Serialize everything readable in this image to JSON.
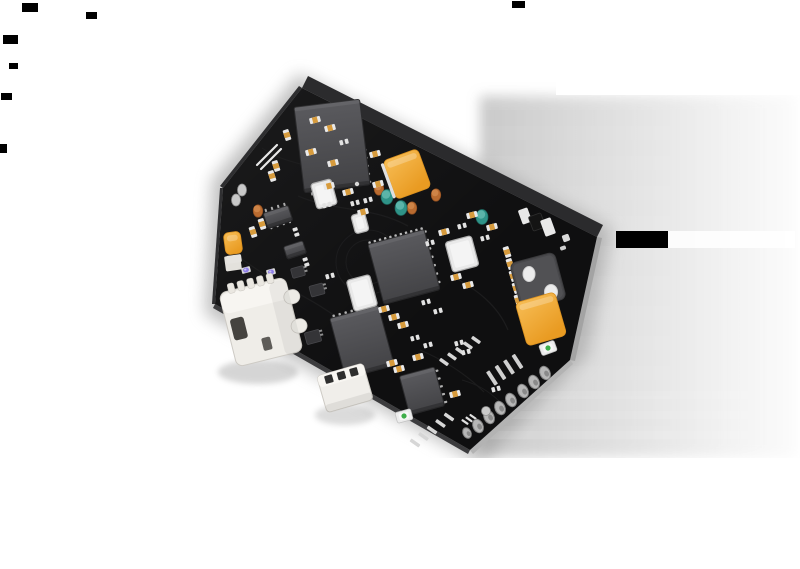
{
  "meta": {
    "description": "3D render of a black hexagonal PCB dev board tilted in perspective, with micro-USB and JST connectors, two amber components, chips, capacitors, castellated pads, a soft gray drop shadow and small black render artifacts on a white background",
    "background": "#ffffff",
    "width": 800,
    "height": 569
  },
  "palette": {
    "board": "#0F0F10",
    "chip_dark": "#454548",
    "chip_mid": "#56565A",
    "amber": "#F0A733",
    "teal": "#2F9388",
    "rust": "#B96B30",
    "ivory": "#EFEDE8",
    "pad_white": "#E9E9E9",
    "purple": "#8F7FE8",
    "led_green": "#3FAE4A",
    "shadow_gray": "#9B9B9B"
  },
  "artifacts": [
    [
      22,
      3,
      16,
      9
    ],
    [
      86,
      12,
      11,
      7
    ],
    [
      3,
      35,
      15,
      9
    ],
    [
      9,
      63,
      9,
      6
    ],
    [
      1,
      93,
      11,
      7
    ],
    [
      512,
      1,
      13,
      7
    ],
    [
      0,
      144,
      7,
      9
    ],
    [
      616,
      231,
      52,
      17
    ]
  ],
  "shadow": {
    "halo": {
      "pts": [
        [
          298,
          74
        ],
        [
          612,
          228
        ],
        [
          588,
          354
        ],
        [
          480,
          464
        ],
        [
          205,
          314
        ],
        [
          212,
          180
        ]
      ],
      "fill": "#8E8E8E",
      "opacity": 0.55
    },
    "sheet": {
      "x": 480,
      "y": 96,
      "w": 315,
      "h": 361
    },
    "bands": {
      "count": 12,
      "x": 480,
      "y0": 96,
      "step": 30,
      "h": 14,
      "w": 315,
      "opacity": 0.045
    },
    "bands2": [
      [
        480,
        391,
        315,
        8
      ],
      [
        480,
        411,
        315,
        8
      ],
      [
        480,
        431,
        315,
        8
      ]
    ],
    "gap": [
      668,
      231,
      127,
      17
    ],
    "cut_bottom": [
      428,
      458,
      372,
      111
    ],
    "cut_top": [
      556,
      58,
      244,
      37
    ]
  },
  "board": {
    "outline": [
      [
        302,
        88
      ],
      [
        597,
        237
      ],
      [
        570,
        360
      ],
      [
        470,
        450
      ],
      [
        215,
        304
      ],
      [
        223,
        188
      ]
    ],
    "fill": "#0F0F10",
    "walls": [
      {
        "name": "wall-top-right",
        "pts": [
          [
            302,
            88
          ],
          [
            597,
            237
          ],
          [
            603,
            225
          ],
          [
            308,
            76
          ]
        ],
        "fill": "#2B2B2D"
      },
      {
        "name": "wall-right",
        "pts": [
          [
            597,
            237
          ],
          [
            570,
            360
          ],
          [
            575,
            361
          ],
          [
            602,
            238
          ]
        ],
        "fill": "#A3A3A3"
      },
      {
        "name": "wall-bottom-right",
        "pts": [
          [
            570,
            360
          ],
          [
            470,
            450
          ],
          [
            473,
            454
          ],
          [
            573,
            364
          ]
        ],
        "fill": "#B3B3B3"
      },
      {
        "name": "wall-bottom-left",
        "pts": [
          [
            470,
            450
          ],
          [
            215,
            304
          ],
          [
            213,
            308
          ],
          [
            468,
            454
          ]
        ],
        "fill": "#3C3C3E"
      },
      {
        "name": "wall-left",
        "pts": [
          [
            215,
            304
          ],
          [
            223,
            188
          ],
          [
            220,
            188
          ],
          [
            212,
            304
          ]
        ],
        "fill": "#303032"
      },
      {
        "name": "wall-top-left",
        "pts": [
          [
            223,
            188
          ],
          [
            302,
            88
          ],
          [
            299,
            86
          ],
          [
            220,
            186
          ]
        ],
        "fill": "#2E2E30"
      }
    ]
  },
  "traces": [
    {
      "d": "M238,256 C275,285 315,298 348,326",
      "w": 1.3
    },
    {
      "d": "M298,196 C335,212 372,206 408,226",
      "w": 1.3
    },
    {
      "d": "M452,276 C478,290 498,306 508,330",
      "w": 1.2
    },
    {
      "d": "M262,148 C288,166 306,160 322,176",
      "w": 1.2
    },
    {
      "d": "M420,350 C448,362 468,376 484,392",
      "w": 1.2
    },
    {
      "d": "M500,402 C488,390 476,384 462,380",
      "w": 1.0
    },
    {
      "d": "M346,262 a22,22 0 1 0 44,0 a22,22 0 1 0 -44,0",
      "w": 1.0
    },
    {
      "d": "M336,262 a32,32 0 1 0 64,0 a32,32 0 1 0 -64,0",
      "w": 1.0
    }
  ],
  "pin_rows": [
    {
      "name": "qfn-pins-top",
      "x": 370,
      "y": 244,
      "c": 11,
      "dx": 5.2,
      "dy": -1.4,
      "w": 2.4,
      "h": 5.5,
      "r": -15,
      "f": "#B8B8B8"
    },
    {
      "name": "qfn-pins-right",
      "x": 424,
      "y": 232,
      "c": 7,
      "dx": 2.3,
      "dy": 8.4,
      "w": 5.5,
      "h": 2.4,
      "r": -15,
      "f": "#B8B8B8"
    },
    {
      "name": "module-pins-right",
      "x": 364,
      "y": 150,
      "c": 5,
      "dx": 1.2,
      "dy": 8,
      "w": 5,
      "h": 2.2,
      "r": -7,
      "f": "#9C9C9C"
    },
    {
      "name": "module-pins-bottom",
      "x": 312,
      "y": 193,
      "c": 3,
      "dx": 9,
      "dy": -1.1,
      "w": 2.2,
      "h": 5,
      "r": -7,
      "f": "#9C9C9C"
    },
    {
      "name": "chipb-pins-top",
      "x": 334,
      "y": 317,
      "c": 8,
      "dx": 6,
      "dy": -1.6,
      "w": 2.4,
      "h": 5,
      "r": -15,
      "f": "#B0B0B0"
    },
    {
      "name": "chipc-pins-right",
      "x": 436,
      "y": 371,
      "c": 5,
      "dx": 2.2,
      "dy": 7.8,
      "w": 5,
      "h": 2.2,
      "r": -15,
      "f": "#B0B0B0"
    },
    {
      "name": "soic-pins-top",
      "x": 266,
      "y": 211,
      "c": 4,
      "dx": 6.2,
      "dy": -2,
      "w": 2,
      "h": 4.5,
      "r": -18,
      "f": "#ABABAB"
    },
    {
      "name": "soic-pins-bottom",
      "x": 271,
      "y": 227,
      "c": 4,
      "dx": 6.2,
      "dy": -2,
      "w": 2,
      "h": 4.5,
      "r": -18,
      "f": "#ABABAB"
    },
    {
      "name": "edge-pads-row-a",
      "x": 415,
      "y": 443,
      "c": 5,
      "dx": 8.5,
      "dy": -6.5,
      "w": 3.5,
      "h": 11,
      "r": -55,
      "f": "#D6D6D6"
    },
    {
      "name": "edge-pads-row-b",
      "x": 444,
      "y": 362,
      "c": 5,
      "dx": 8,
      "dy": -5.5,
      "w": 3.5,
      "h": 10,
      "r": -55,
      "f": "#D6D6D6"
    },
    {
      "name": "ladder-footprint",
      "x": 492,
      "y": 378,
      "c": 4,
      "dx": 8.5,
      "dy": -5.5,
      "w": 4,
      "h": 16,
      "r": -33,
      "f": "#CFCFCF"
    },
    {
      "name": "e-mark-pads",
      "x": 465,
      "y": 422,
      "c": 3,
      "dx": 4,
      "dy": -2.6,
      "w": 2.2,
      "h": 8,
      "r": -55,
      "f": "#E0E0E0"
    }
  ],
  "chips": [
    {
      "name": "rf-module-chip",
      "x": 332,
      "y": 146,
      "w": 66,
      "h": 86,
      "r": -7
    },
    {
      "name": "main-mcu-qfn",
      "x": 404,
      "y": 267,
      "w": 58,
      "h": 62,
      "r": -15
    },
    {
      "name": "chip-b",
      "x": 362,
      "y": 342,
      "w": 50,
      "h": 62,
      "r": -15
    },
    {
      "name": "chip-c",
      "x": 422,
      "y": 391,
      "w": 36,
      "h": 40,
      "r": -15
    },
    {
      "name": "soic8-chip",
      "x": 278,
      "y": 217,
      "w": 26,
      "h": 16,
      "r": -18
    },
    {
      "name": "small-ic",
      "x": 295,
      "y": 250,
      "w": 20,
      "h": 13,
      "r": -18
    }
  ],
  "sots": [
    [
      298,
      272,
      13,
      10
    ],
    [
      317,
      290,
      14,
      11
    ],
    [
      313,
      337,
      15,
      12
    ]
  ],
  "crystals": [
    [
      324,
      194,
      21,
      26
    ],
    [
      360,
      223,
      14,
      19
    ],
    [
      462,
      254,
      27,
      31
    ],
    [
      362,
      293,
      24,
      32
    ]
  ],
  "buttons": [
    {
      "name": "amber-component-top",
      "x": 407,
      "y": 174,
      "w": 37,
      "h": 41,
      "r": -20,
      "rim": true
    },
    {
      "name": "amber-component-right",
      "x": 541,
      "y": 319,
      "w": 41,
      "h": 45,
      "r": -16,
      "rim": false
    },
    {
      "name": "gold-capacitor",
      "x": 233,
      "y": 243,
      "w": 17,
      "h": 22,
      "r": -8,
      "rim": false
    }
  ],
  "rects": [
    {
      "name": "white-part-near-corner",
      "x": 525,
      "y": 216,
      "w": 10,
      "h": 15,
      "r": -20,
      "f": "#E8E8E8"
    },
    {
      "name": "black-part-near-corner",
      "x": 537,
      "y": 222,
      "w": 13,
      "h": 15,
      "r": -20,
      "f": "#141414",
      "s": "#2F2F2F"
    },
    {
      "name": "white-part-near-corner-2",
      "x": 548,
      "y": 227,
      "w": 11,
      "h": 17,
      "r": -20,
      "f": "#E8E8E8"
    },
    {
      "name": "tiny-white-pad",
      "x": 566,
      "y": 238,
      "w": 7,
      "h": 7,
      "r": -20,
      "f": "#DADADA"
    },
    {
      "name": "tiny-white-pad-2",
      "x": 563,
      "y": 248,
      "w": 6,
      "h": 4,
      "r": -20,
      "f": "#CFCFCF"
    },
    {
      "name": "white-bracket",
      "x": 233,
      "y": 263,
      "w": 16,
      "h": 15,
      "r": -8,
      "f": "#E3E1DC"
    },
    {
      "name": "gold-cap-base",
      "x": 234,
      "y": 259,
      "w": 15,
      "h": 8,
      "r": -8,
      "f": "#E6E4E0"
    }
  ],
  "cyls": {
    "rust": [
      [
        379,
        189
      ],
      [
        412,
        208
      ],
      [
        436,
        195
      ],
      [
        258,
        211
      ]
    ],
    "teal": [
      [
        387,
        197
      ],
      [
        401,
        208
      ],
      [
        482,
        217
      ]
    ]
  },
  "caps": [
    [
      287,
      135,
      72
    ],
    [
      276,
      166,
      72
    ],
    [
      272,
      176,
      72
    ],
    [
      262,
      224,
      72
    ],
    [
      253,
      232,
      72
    ],
    [
      311,
      152,
      -15
    ],
    [
      333,
      163,
      -15
    ],
    [
      348,
      192,
      -15
    ],
    [
      329,
      186,
      -15
    ],
    [
      363,
      212,
      -15
    ],
    [
      375,
      154,
      -15
    ],
    [
      378,
      184,
      -15
    ],
    [
      444,
      232,
      -15
    ],
    [
      456,
      277,
      -15
    ],
    [
      468,
      285,
      -15
    ],
    [
      384,
      309,
      -15
    ],
    [
      394,
      317,
      -15
    ],
    [
      403,
      325,
      -15
    ],
    [
      418,
      357,
      -15
    ],
    [
      392,
      363,
      -15
    ],
    [
      399,
      369,
      -15
    ],
    [
      455,
      394,
      -15
    ],
    [
      472,
      215,
      -15
    ],
    [
      492,
      227,
      -15
    ],
    [
      315,
      120,
      -15
    ],
    [
      330,
      128,
      -15
    ],
    [
      507,
      252,
      72
    ],
    [
      510,
      264,
      72
    ],
    [
      513,
      276,
      72
    ],
    [
      516,
      288,
      72
    ],
    [
      518,
      300,
      72
    ]
  ],
  "pad_pairs": [
    [
      344,
      142,
      -15
    ],
    [
      355,
      203,
      -15
    ],
    [
      368,
      200,
      -15
    ],
    [
      430,
      243,
      -15
    ],
    [
      462,
      226,
      -15
    ],
    [
      485,
      238,
      -15
    ],
    [
      327,
      205,
      -15
    ],
    [
      296,
      232,
      72
    ],
    [
      306,
      262,
      72
    ],
    [
      330,
      276,
      -15
    ],
    [
      426,
      302,
      -15
    ],
    [
      438,
      311,
      -15
    ],
    [
      415,
      338,
      -15
    ],
    [
      428,
      345,
      -15
    ],
    [
      459,
      343,
      -15
    ],
    [
      466,
      352,
      -15
    ],
    [
      523,
      305,
      -15
    ],
    [
      528,
      316,
      -15
    ],
    [
      496,
      389,
      -15
    ]
  ],
  "castellations": [
    [
      478,
      426,
      5,
      7
    ],
    [
      489,
      417,
      5,
      7
    ],
    [
      500,
      408,
      5,
      7
    ],
    [
      511,
      400,
      5,
      7
    ],
    [
      523,
      391,
      5,
      7
    ],
    [
      534,
      382,
      5,
      7
    ],
    [
      545,
      373,
      5,
      7
    ],
    [
      467,
      433,
      4,
      5.5
    ]
  ],
  "test_pads": [
    [
      242,
      190,
      4.5,
      6
    ],
    [
      236,
      200,
      4.5,
      6
    ],
    [
      486,
      411,
      4.5,
      4.5
    ]
  ],
  "dots": [
    [
      357,
      184,
      2.2
    ]
  ],
  "purple_leds": [
    [
      246,
      270,
      -15
    ],
    [
      271,
      272,
      -15
    ],
    [
      275,
      287,
      -15
    ]
  ],
  "green_leds": [
    [
      404,
      416,
      -15
    ],
    [
      548,
      348,
      -20
    ]
  ],
  "silk_lines": [
    [
      257,
      165,
      277,
      145
    ],
    [
      261,
      169,
      281,
      149
    ]
  ],
  "dual_component": {
    "name": "dual-hole-component",
    "x": 538,
    "y": 281,
    "w": 46,
    "h": 48,
    "r": -15,
    "holes": [
      [
        529,
        274,
        6,
        7.5
      ],
      [
        551,
        292,
        6.5,
        7.5
      ]
    ]
  },
  "usb": {
    "name": "micro-usb-connector",
    "x": 261,
    "y": 322,
    "r": -14
  },
  "jst": {
    "name": "jst-connector",
    "x": 345,
    "y": 388,
    "r": -16
  },
  "soft_shadows": [
    [
      258,
      372,
      40,
      12,
      0.35
    ],
    [
      345,
      415,
      30,
      10,
      0.3
    ]
  ]
}
